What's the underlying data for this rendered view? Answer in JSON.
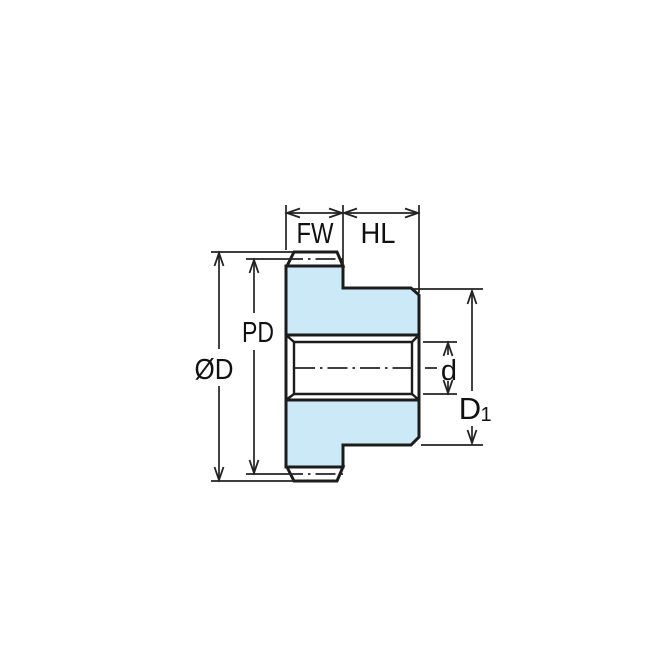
{
  "diagram": {
    "labels": {
      "face_width": "FW",
      "hub_length": "HL",
      "pitch_diameter": "PD",
      "outer_diameter": "ØD",
      "bore_diameter": "d",
      "hub_diameter": {
        "main": "D",
        "sub": "1"
      }
    },
    "colors": {
      "part_fill": "#CCE9F7",
      "tooth_fill": "#FFFFFF",
      "outline": "#1C1C1C",
      "dimension_line": "#222222",
      "text": "#111111",
      "background": "#FFFFFF"
    }
  }
}
